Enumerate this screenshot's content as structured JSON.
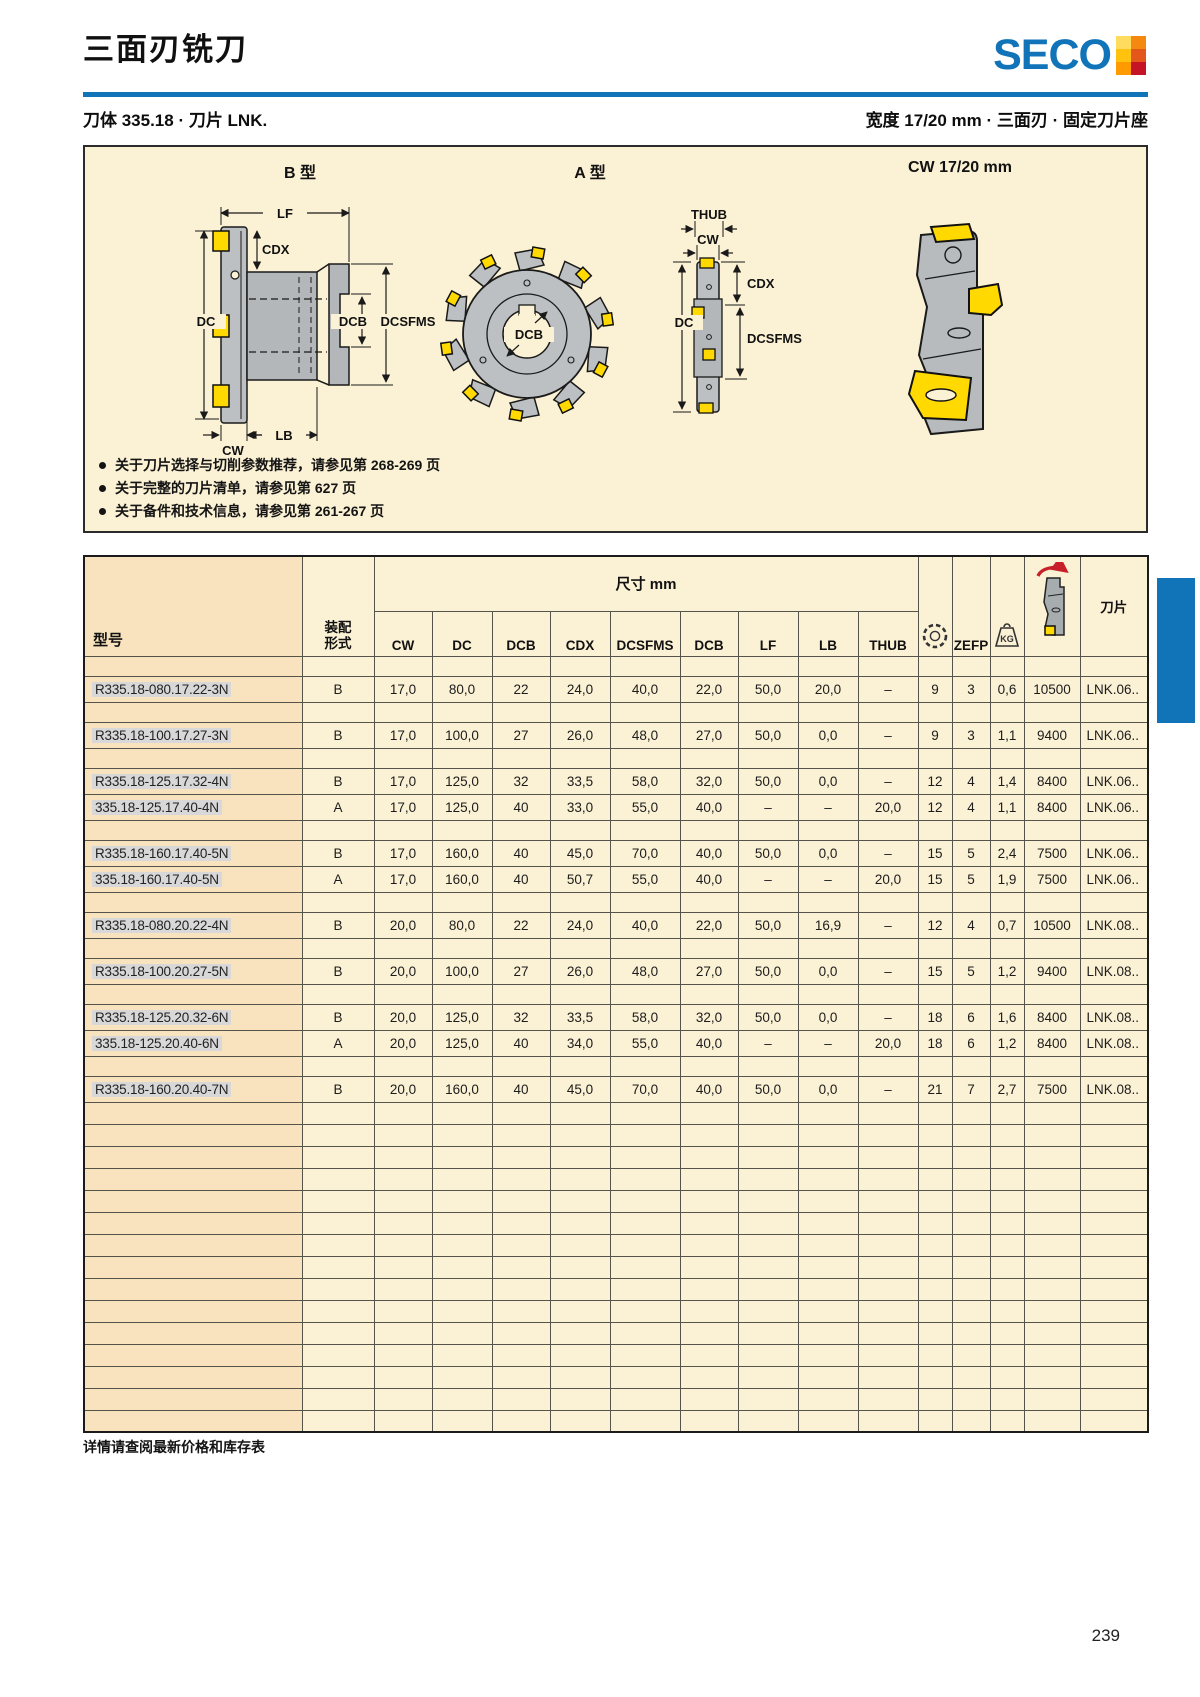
{
  "page": {
    "title": "三面刃铣刀",
    "footer_note": "详情请查阅最新价格和库存表",
    "page_number": "239"
  },
  "brand": {
    "logo_text": "SECO",
    "accent_blue": "#1173b8",
    "mark_tiles": [
      "#ffdb5e",
      "#f5890f",
      "#ffc20e",
      "#e4571b",
      "#ff9b00",
      "#c41425"
    ]
  },
  "subheader": {
    "left": "刀体 335.18 · 刀片 LNK.",
    "right": "宽度 17/20 mm · 三面刃 · 固定刀片座"
  },
  "diagram": {
    "b_label": "B 型",
    "a_label": "A 型",
    "cw_label": "CW 17/20 mm",
    "b_dims": {
      "lf": "LF",
      "cdx": "CDX",
      "dc": "DC",
      "dcb": "DCB",
      "dcsfms": "DCSFMS",
      "lb": "LB",
      "cw": "CW"
    },
    "front_dim": "DCB",
    "side_dims": {
      "thub": "THUB",
      "cw": "CW",
      "cdx": "CDX",
      "dc": "DC",
      "dcsfms": "DCSFMS"
    },
    "notes": [
      "关于刀片选择与切削参数推荐，请参见第 268-269 页",
      "关于完整的刀片清单，请参见第 627 页",
      "关于备件和技术信息，请参见第 261-267 页"
    ]
  },
  "table": {
    "col_model": "型号",
    "mount_line1": "装配",
    "mount_line2": "形式",
    "dim_group": "尺寸 mm",
    "dim_cols": [
      "CW",
      "DC",
      "DCB",
      "CDX",
      "DCSFMS",
      "DCB",
      "LF",
      "LB",
      "THUB"
    ],
    "col_zefp": "ZEFP",
    "col_kg_label": "KG",
    "col_insert": "刀片",
    "icon_names": [
      "cutter-teeth-icon",
      "weight-kg-icon",
      "max-rpm-icon"
    ],
    "rows": [
      {
        "model": "R335.18-080.17.22-3N",
        "mount": "B",
        "dims": [
          "17,0",
          "80,0",
          "22",
          "24,0",
          "40,0",
          "22,0",
          "50,0",
          "20,0",
          "–"
        ],
        "teeth": "9",
        "zefp": "3",
        "kg": "0,6",
        "rpm": "10500",
        "insert": "LNK.06.."
      },
      {
        "model": "R335.18-100.17.27-3N",
        "mount": "B",
        "dims": [
          "17,0",
          "100,0",
          "27",
          "26,0",
          "48,0",
          "27,0",
          "50,0",
          "0,0",
          "–"
        ],
        "teeth": "9",
        "zefp": "3",
        "kg": "1,1",
        "rpm": "9400",
        "insert": "LNK.06.."
      },
      {
        "model": "R335.18-125.17.32-4N",
        "mount": "B",
        "dims": [
          "17,0",
          "125,0",
          "32",
          "33,5",
          "58,0",
          "32,0",
          "50,0",
          "0,0",
          "–"
        ],
        "teeth": "12",
        "zefp": "4",
        "kg": "1,4",
        "rpm": "8400",
        "insert": "LNK.06.."
      },
      {
        "model": "335.18-125.17.40-4N",
        "mount": "A",
        "dims": [
          "17,0",
          "125,0",
          "40",
          "33,0",
          "55,0",
          "40,0",
          "–",
          "–",
          "20,0"
        ],
        "teeth": "12",
        "zefp": "4",
        "kg": "1,1",
        "rpm": "8400",
        "insert": "LNK.06.."
      },
      {
        "model": "R335.18-160.17.40-5N",
        "mount": "B",
        "dims": [
          "17,0",
          "160,0",
          "40",
          "45,0",
          "70,0",
          "40,0",
          "50,0",
          "0,0",
          "–"
        ],
        "teeth": "15",
        "zefp": "5",
        "kg": "2,4",
        "rpm": "7500",
        "insert": "LNK.06.."
      },
      {
        "model": "335.18-160.17.40-5N",
        "mount": "A",
        "dims": [
          "17,0",
          "160,0",
          "40",
          "50,7",
          "55,0",
          "40,0",
          "–",
          "–",
          "20,0"
        ],
        "teeth": "15",
        "zefp": "5",
        "kg": "1,9",
        "rpm": "7500",
        "insert": "LNK.06.."
      },
      {
        "model": "R335.18-080.20.22-4N",
        "mount": "B",
        "dims": [
          "20,0",
          "80,0",
          "22",
          "24,0",
          "40,0",
          "22,0",
          "50,0",
          "16,9",
          "–"
        ],
        "teeth": "12",
        "zefp": "4",
        "kg": "0,7",
        "rpm": "10500",
        "insert": "LNK.08.."
      },
      {
        "model": "R335.18-100.20.27-5N",
        "mount": "B",
        "dims": [
          "20,0",
          "100,0",
          "27",
          "26,0",
          "48,0",
          "27,0",
          "50,0",
          "0,0",
          "–"
        ],
        "teeth": "15",
        "zefp": "5",
        "kg": "1,2",
        "rpm": "9400",
        "insert": "LNK.08.."
      },
      {
        "model": "R335.18-125.20.32-6N",
        "mount": "B",
        "dims": [
          "20,0",
          "125,0",
          "32",
          "33,5",
          "58,0",
          "32,0",
          "50,0",
          "0,0",
          "–"
        ],
        "teeth": "18",
        "zefp": "6",
        "kg": "1,6",
        "rpm": "8400",
        "insert": "LNK.08.."
      },
      {
        "model": "335.18-125.20.40-6N",
        "mount": "A",
        "dims": [
          "20,0",
          "125,0",
          "40",
          "34,0",
          "55,0",
          "40,0",
          "–",
          "–",
          "20,0"
        ],
        "teeth": "18",
        "zefp": "6",
        "kg": "1,2",
        "rpm": "8400",
        "insert": "LNK.08.."
      },
      {
        "model": "R335.18-160.20.40-7N",
        "mount": "B",
        "dims": [
          "20,0",
          "160,0",
          "40",
          "45,0",
          "70,0",
          "40,0",
          "50,0",
          "0,0",
          "–"
        ],
        "teeth": "21",
        "zefp": "7",
        "kg": "2,7",
        "rpm": "7500",
        "insert": "LNK.08.."
      }
    ],
    "groups": [
      [
        0
      ],
      [
        1
      ],
      [
        2,
        3
      ],
      [
        4,
        5
      ],
      [
        6
      ],
      [
        7
      ],
      [
        8,
        9
      ],
      [
        10
      ]
    ],
    "empty_rows": 15
  },
  "colors": {
    "cream": "#fbf1d4",
    "peach": "#f9e3be",
    "accent_blue": "#1173b8",
    "insert_yellow": "#ffd900",
    "tool_gray": "#bcc0c2"
  }
}
